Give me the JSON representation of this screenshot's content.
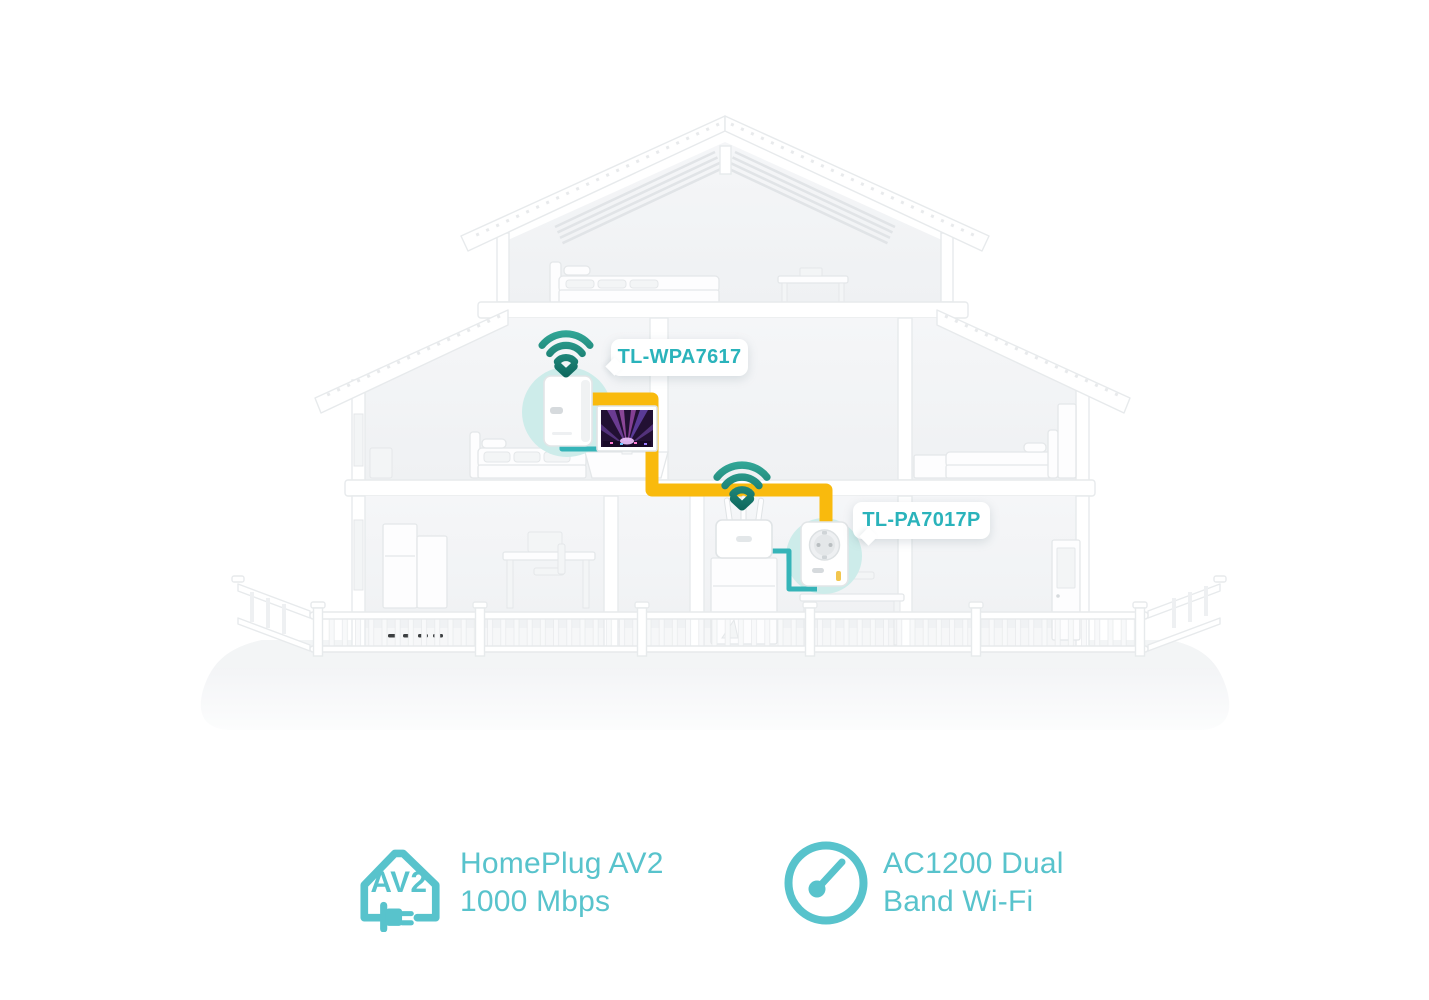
{
  "callouts": {
    "extender_label": "TL-WPA7617",
    "adapter_label": "TL-PA7017P"
  },
  "features": [
    {
      "icon": "homeplug-av2-house-plug-icon",
      "badge_text": "AV2",
      "line1": "HomePlug AV2",
      "line2": "1000 Mbps"
    },
    {
      "icon": "speedometer-icon",
      "line1": "AC1200 Dual",
      "line2": "Band Wi-Fi"
    }
  ],
  "devices": [
    {
      "name": "wifi-powerline-extender",
      "label": "TL-WPA7617"
    },
    {
      "name": "passthrough-powerline-adapter",
      "label": "TL-PA7017P"
    }
  ],
  "colors": {
    "callout_text": "#2AB3BB",
    "feature_teal": "#58C3CC",
    "cable_yellow": "#F9BA0D",
    "cable_teal": "#35B4B8",
    "halo_teal": "#CDECEA",
    "wifi_top": "#33A898",
    "wifi_bottom": "#0E675D"
  }
}
